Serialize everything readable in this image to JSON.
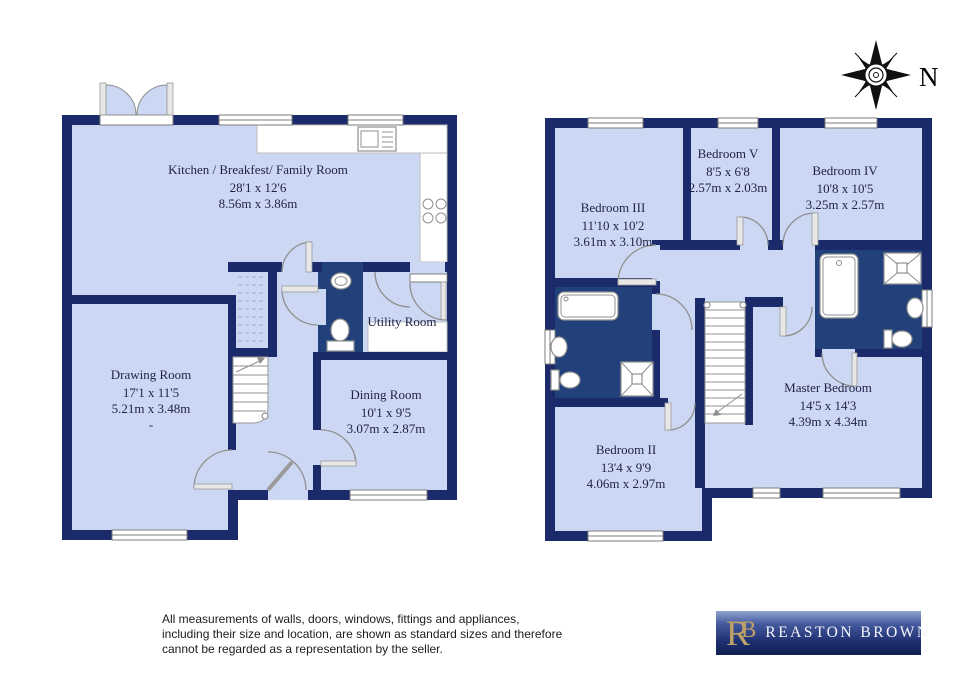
{
  "palette": {
    "wall_navy": "#1a2a6a",
    "room_fill": "#ccd7f3",
    "bathroom_fill": "#224079",
    "logo_gold": "#bfa268",
    "logo_gradient_top": "#8fa5d0",
    "logo_gradient_bottom": "#122153"
  },
  "compass": {
    "north_label": "N"
  },
  "floors": {
    "ground": {
      "rooms": {
        "kitchen": {
          "name": "Kitchen / Breakfest/ Family Room",
          "imperial": "28'1 x 12'6",
          "metric": "8.56m x 3.86m"
        },
        "drawing": {
          "name": "Drawing Room",
          "imperial": "17'1 x 11'5",
          "metric": "5.21m x 3.48m",
          "note": "-"
        },
        "dining": {
          "name": "Dining Room",
          "imperial": "10'1 x 9'5",
          "metric": "3.07m x 2.87m"
        },
        "utility": {
          "name": "Utility Room"
        }
      }
    },
    "first": {
      "rooms": {
        "bedroom3": {
          "name": "Bedroom III",
          "imperial": "11'10 x 10'2",
          "metric": "3.61m x 3.10m"
        },
        "bedroom5": {
          "name": "Bedroom V",
          "imperial": "8'5 x 6'8",
          "metric": "2.57m x 2.03m"
        },
        "bedroom4": {
          "name": "Bedroom IV",
          "imperial": "10'8 x 10'5",
          "metric": "3.25m x 2.57m"
        },
        "bedroom2": {
          "name": "Bedroom II",
          "imperial": "13'4 x 9'9",
          "metric": "4.06m x 2.97m"
        },
        "master": {
          "name": "Master Bedroom",
          "imperial": "14'5 x 14'3",
          "metric": "4.39m x 4.34m"
        }
      }
    }
  },
  "disclaimer": {
    "lines": [
      "All measurements of walls, doors, windows, fittings and appliances,",
      "including their size and location, are shown as standard sizes and therefore",
      "cannot be regarded as a representation by the seller."
    ]
  },
  "logo": {
    "monogram_r": "R",
    "monogram_b": "B",
    "name": "REASTON BROWN"
  }
}
